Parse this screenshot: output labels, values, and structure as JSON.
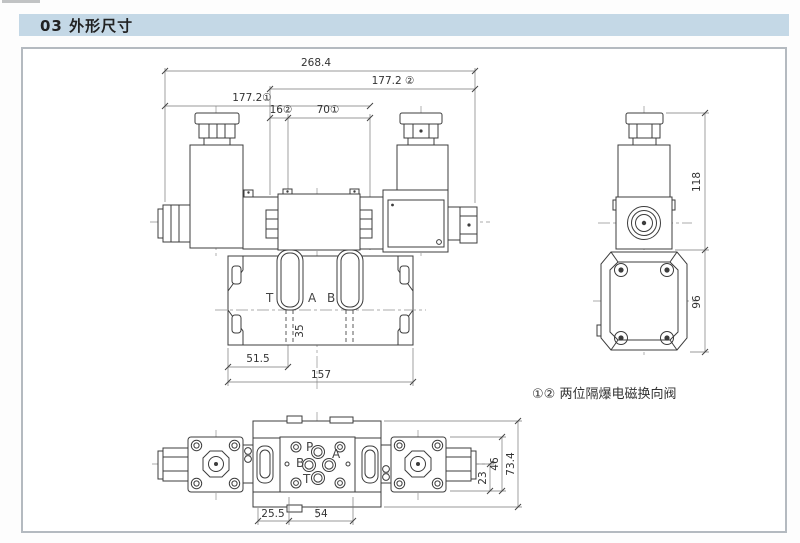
{
  "header": {
    "title": "03 外形尺寸"
  },
  "colors": {
    "header_bg": "#c4d8e6",
    "frame_border": "#b4bac0",
    "line": "#3c3c3c",
    "dim_text": "#333333",
    "background": "#ffffff"
  },
  "front_view": {
    "dims": {
      "overall_width": "268.4",
      "width_variant2": "177.2 ②",
      "width_variant1": "177.2①",
      "offset_16": "16②",
      "offset_70": "70①",
      "port_offset": "51.5",
      "base_width": "157",
      "base_depth": "35"
    },
    "ports": {
      "t": "T",
      "a": "A",
      "b": "B"
    }
  },
  "side_view": {
    "dims": {
      "total_height": "118",
      "base_height": "96"
    }
  },
  "plan_view": {
    "dims": {
      "offset_25_5": "25.5",
      "offset_54": "54",
      "dim_23": "23",
      "dim_46": "46",
      "dim_73_4": "73.4"
    },
    "ports": {
      "p": "P",
      "a": "A",
      "b": "B",
      "t": "T"
    }
  },
  "note": {
    "text": "①② 两位隔爆电磁换向阀"
  }
}
